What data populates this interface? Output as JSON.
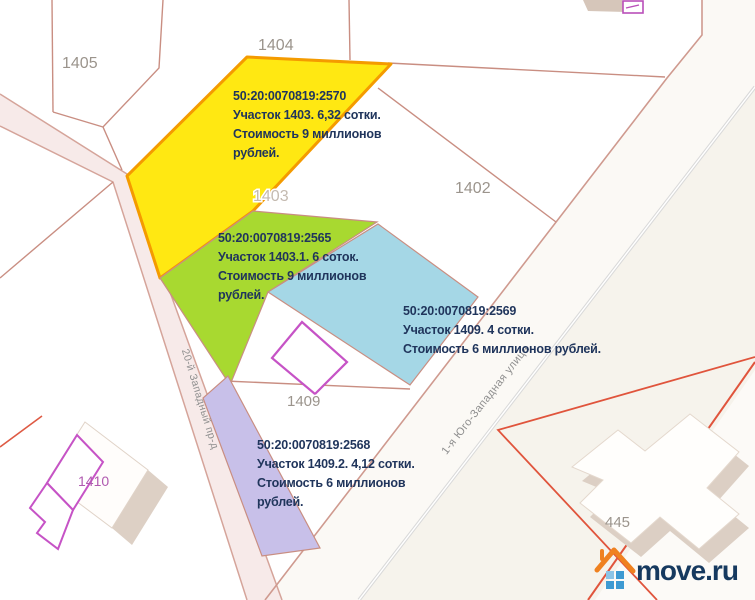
{
  "map_title": "Cadastral plot map",
  "parcel_labels": {
    "p1405": "1405",
    "p1404": "1404",
    "p1403": "1403",
    "p1402": "1402",
    "p1409": "1409",
    "p1410": "1410",
    "p445": "445"
  },
  "streets": {
    "left": "20-й Западный пр-д",
    "right": "1-я Юго-Западная улица"
  },
  "annotations": [
    {
      "lines": [
        "50:20:0070819:2570",
        "Участок 1403. 6,32 сотки.",
        "Стоимость 9 миллионов",
        "рублей."
      ]
    },
    {
      "lines": [
        "50:20:0070819:2565",
        "Участок 1403.1. 6 соток.",
        "Стоимость 9 миллионов",
        "рублей."
      ]
    },
    {
      "lines": [
        "50:20:0070819:2569",
        "Участок 1409. 4 сотки.",
        "Стоимость 6 миллионов рублей."
      ]
    },
    {
      "lines": [
        "50:20:0070819:2568",
        "Участок 1409.2. 4,12 сотки.",
        "Стоимость 6 миллионов",
        "рублей."
      ]
    }
  ],
  "logo": {
    "text": "move.ru"
  },
  "colors": {
    "plot_yellow": "#ffe812",
    "plot_yellow_border": "#f49b00",
    "plot_green": "#a8d930",
    "plot_blue": "#a5d7e6",
    "plot_purple": "#c8c0e9",
    "boundary_salmon": "#c98e82",
    "road_red": "#e0543c",
    "building_magenta": "#c653c6",
    "annotation_text": "#20355c",
    "logo_orange": "#ef8120",
    "logo_blue": "#3e9ad2",
    "logo_text": "#16395f"
  }
}
